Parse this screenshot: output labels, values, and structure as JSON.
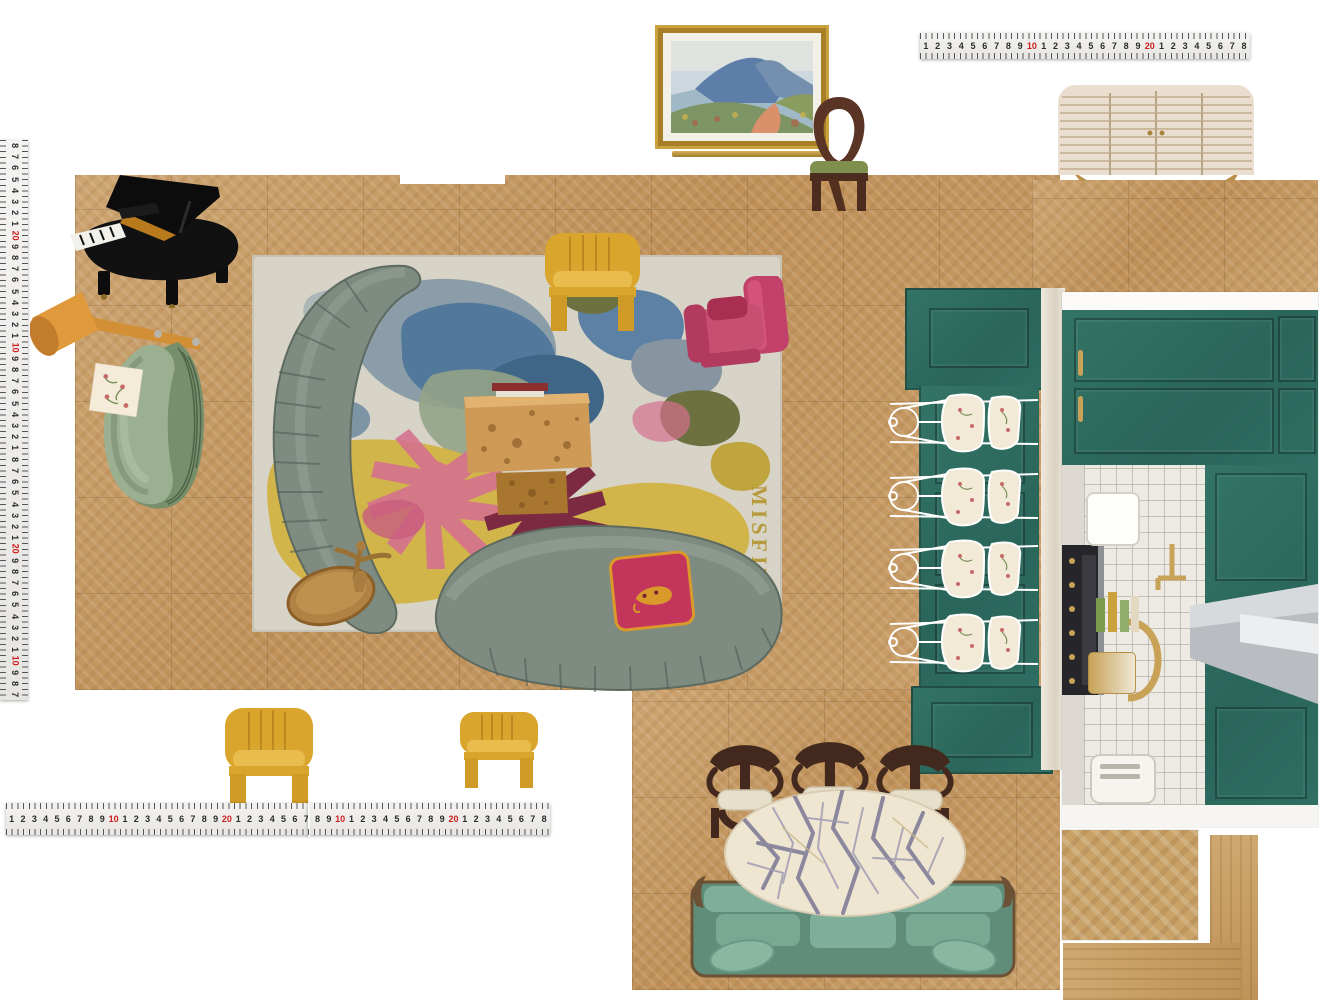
{
  "canvas": {
    "width": 1334,
    "height": 1000,
    "background": "#ffffff"
  },
  "board_type": "interior-design-floorplan-moodboard",
  "rulers": {
    "left": {
      "orientation": "vertical",
      "numbers": [
        "8",
        "7",
        "6",
        "5",
        "4",
        "3",
        "2",
        "1",
        "20",
        "9",
        "8",
        "7",
        "6",
        "5",
        "4",
        "3",
        "2",
        "1",
        "10",
        "9",
        "8",
        "7",
        "6",
        "5",
        "4",
        "3",
        "2",
        "1",
        "8",
        "7",
        "6",
        "5",
        "4",
        "3",
        "2",
        "1",
        "20",
        "9",
        "8",
        "7",
        "6",
        "5",
        "4",
        "3",
        "2",
        "1",
        "10",
        "9",
        "8",
        "7"
      ]
    },
    "top": {
      "orientation": "horizontal",
      "numbers": [
        "1",
        "2",
        "3",
        "4",
        "5",
        "6",
        "7",
        "8",
        "9",
        "10",
        "1",
        "2",
        "3",
        "4",
        "5",
        "6",
        "7",
        "8",
        "9",
        "20",
        "1",
        "2",
        "3",
        "4",
        "5",
        "6",
        "7",
        "8"
      ]
    },
    "bottom": {
      "orientation": "horizontal",
      "numbers": [
        "1",
        "2",
        "3",
        "4",
        "5",
        "6",
        "7",
        "8",
        "9",
        "10",
        "1",
        "2",
        "3",
        "4",
        "5",
        "6",
        "7",
        "8",
        "9",
        "20",
        "1",
        "2",
        "3",
        "4",
        "5",
        "6",
        "7",
        "8",
        "9",
        "10",
        "1",
        "2",
        "3",
        "4",
        "5",
        "6",
        "7",
        "8",
        "9",
        "20",
        "1",
        "2",
        "3",
        "4",
        "5",
        "6",
        "7",
        "8"
      ]
    },
    "red_values": [
      "10",
      "20"
    ]
  },
  "rug": {
    "signature": "MISFIT JOIE"
  },
  "palette": {
    "wood": "#c49a66",
    "teal_cabinet": "#2d6e60",
    "sage_green": "#9bb090",
    "sofa_grey_green": "#7e8b81",
    "mustard_yellow": "#d9a52c",
    "magenta_pink": "#c2416a",
    "marble_cream": "#efe6d2",
    "walnut": "#43291d",
    "brass_gold": "#b08344",
    "rug_base": "#d7d4c7",
    "rug_yellow": "#d2b54a",
    "rug_blue": "#52799b"
  },
  "items": [
    "grand-piano",
    "floor-lamp",
    "fringe-armchair",
    "fabric-swatch",
    "area-rug",
    "curved-sofa-left",
    "curved-sofa-bottom",
    "burl-coffee-table",
    "leopard-pillow",
    "yellow-tub-chair-on-rug",
    "yellow-tub-chair-large",
    "yellow-tub-chair-small",
    "pink-armchair",
    "bronze-side-table",
    "landscape-painting",
    "picture-rail",
    "loop-back-chair",
    "striped-sideboard",
    "green-banquette",
    "wire-dining-chair",
    "kitchen-elevation",
    "dining-chair",
    "marble-oval-table",
    "vintage-green-sofa",
    "herringbone-swatch",
    "plank-swatch-vertical",
    "plank-swatch-horizontal",
    "folding-ruler-left",
    "steel-ruler-top",
    "steel-ruler-bottom"
  ]
}
